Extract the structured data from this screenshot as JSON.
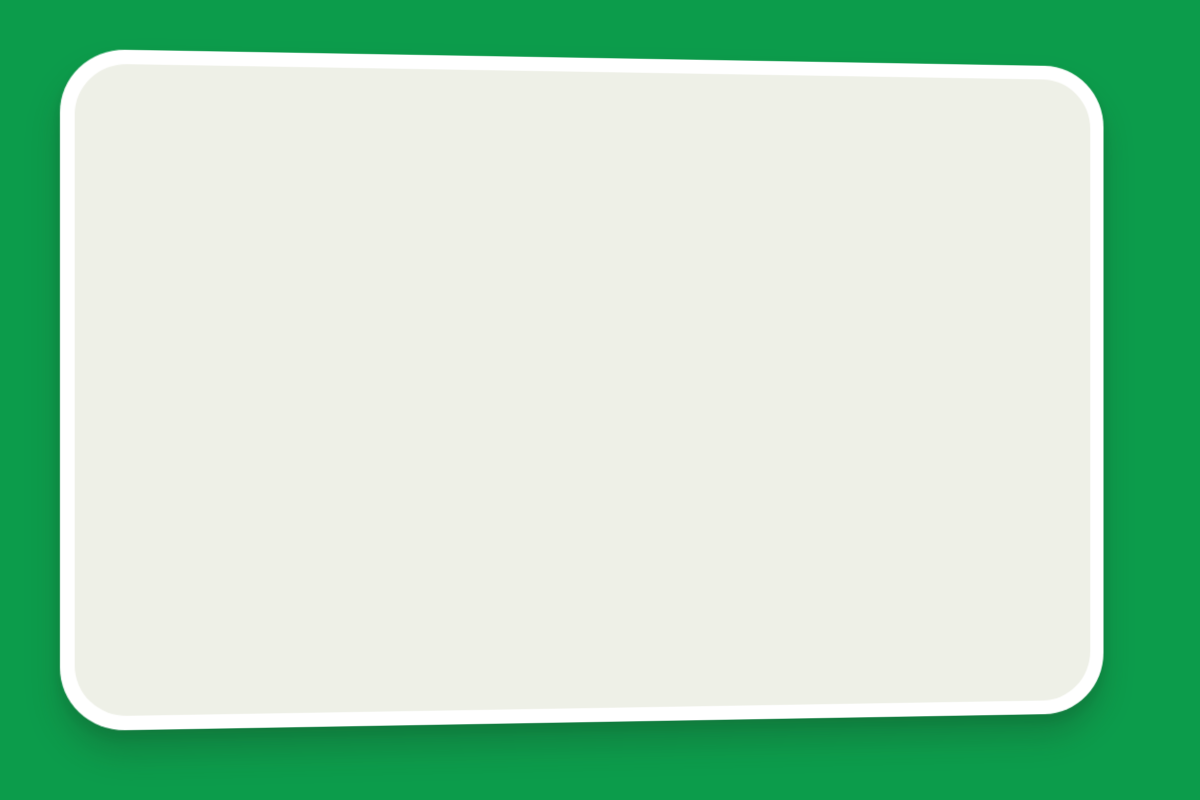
{
  "title": "WOONBLOK H",
  "colors": {
    "green_bg": "#0c9c4b",
    "card": "#ffffff",
    "map_base": "#eef0e7",
    "red_building": "#bf3726",
    "hedge_a": "#61a437",
    "hedge_b": "#417f22",
    "parcel_bg": "#e3eed6",
    "garden": "#d9e9c8",
    "pink_parcel_road": "#f0d8d8",
    "pink_bg_road": "#f5e4e3",
    "salmon": "#dfa89f",
    "road": "#f7f8f4",
    "road_edge": "#dcded4",
    "stall": "#fcfcfa",
    "purple_tree": "#cfc8e0",
    "purple_tree_edge": "#aca2c6",
    "pink_bush": "#e3cfdb",
    "yellow_path": "#efe7ba",
    "yellow_path_dark": "#ded0a0",
    "cars": {
      "gray": "#d6d6d3",
      "orange": "#e39b2d",
      "yellow": "#e6c32f",
      "teal": "#2f93a0",
      "cyan": "#42b6d5",
      "blue": "#4f9bd5",
      "red": "#c23527",
      "green": "#67b63e"
    }
  },
  "scene": {
    "bg_rotation": 42,
    "bands": [
      {
        "v": 1330,
        "h": 115,
        "cls": "yards2"
      },
      {
        "v": 1445,
        "h": 62,
        "cls": "yards"
      },
      {
        "v": 1550,
        "h": 62,
        "cls": "drive",
        "u0": 820,
        "u1": 1460
      },
      {
        "v": 1612,
        "h": 58,
        "cls": "pink",
        "u0": 700,
        "u1": 1420
      },
      {
        "v": 1670,
        "h": 78,
        "cls": "salmon units",
        "u0": 640,
        "u1": 1390
      },
      {
        "v": 1748,
        "h": 55,
        "cls": "yards",
        "u0": 600,
        "u1": 1420
      },
      {
        "v": 1803,
        "h": 46,
        "cls": "road",
        "u0": 500,
        "u1": 1430
      },
      {
        "v": 1849,
        "h": 70,
        "cls": "salmon units",
        "u0": 450,
        "u1": 1360
      },
      {
        "v": 1919,
        "h": 56,
        "cls": "drive",
        "u0": 900,
        "u1": 1950
      },
      {
        "v": 1975,
        "h": 62,
        "cls": "pink",
        "u0": 600,
        "u1": 2100
      },
      {
        "v": 2037,
        "h": 80,
        "cls": "salmon units",
        "u0": 500,
        "u1": 2150
      },
      {
        "v": 2117,
        "h": 60,
        "cls": "yards",
        "u0": 500,
        "u1": 2220
      },
      {
        "v": 2177,
        "h": 48,
        "cls": "road",
        "u0": 500,
        "u1": 2300
      },
      {
        "v": 2225,
        "h": 85,
        "cls": "salmon units",
        "u0": 500,
        "u1": 2300
      }
    ],
    "stall_pairs_world": [
      {
        "u": 870,
        "v": 1562
      },
      {
        "u": 940,
        "v": 1562
      },
      {
        "u": 1010,
        "v": 1562
      },
      {
        "u": 1080,
        "v": 1562
      },
      {
        "u": 1150,
        "v": 1562
      },
      {
        "u": 1290,
        "v": 1562
      },
      {
        "u": 1360,
        "v": 1562
      },
      {
        "u": 1000,
        "v": 1928
      },
      {
        "u": 1070,
        "v": 1928
      },
      {
        "u": 1360,
        "v": 1928
      },
      {
        "u": 1430,
        "v": 1928
      },
      {
        "u": 1680,
        "v": 1928
      },
      {
        "u": 1750,
        "v": 1928
      },
      {
        "u": 1830,
        "v": 1928
      }
    ],
    "world_cars": [
      {
        "u": 1225,
        "v": 1558,
        "c": "red"
      },
      {
        "u": 1500,
        "v": 1930,
        "c": "yellow"
      },
      {
        "u": 1516,
        "v": 1930,
        "c": "yellow"
      },
      {
        "u": 1600,
        "v": 1932,
        "c": "cyan"
      },
      {
        "u": 1616,
        "v": 1932,
        "c": "cyan"
      }
    ],
    "parcel": {
      "x": 366,
      "y": 46,
      "rot": 34,
      "w": 556,
      "h": 348
    },
    "near_parcel": {
      "avenue": {
        "x": -88,
        "y": -60,
        "w": 78,
        "h": 700
      },
      "hedge_lines": [
        -88,
        -16
      ],
      "purple_clusters": [
        {
          "x1": -66,
          "x2": -34,
          "y0": -40,
          "y1": 115
        },
        {
          "x1": -66,
          "x2": -34,
          "y0": 175,
          "y1": 395
        },
        {
          "x1": -66,
          "x2": -34,
          "y0": 430,
          "y1": 625
        },
        {
          "x1": -150,
          "x2": -122,
          "y0": 440,
          "y1": 560
        }
      ],
      "tree_r": 30,
      "tree_step": 30,
      "roads": [
        {
          "x": -170,
          "y": -56,
          "w": 1080,
          "h": 40
        },
        {
          "x": -290,
          "y": 356,
          "w": 1090,
          "h": 42
        }
      ],
      "drive_strip": {
        "x": -290,
        "y": 398,
        "w": 724,
        "h": 56
      },
      "drive_pairs_x": [
        -250,
        -180,
        -110,
        -40,
        30,
        100,
        240,
        310
      ],
      "salmon_bottom": {
        "x": -30,
        "y": 454,
        "w": 780,
        "h": 78
      },
      "pink_bottom": {
        "x": -240,
        "y": 532,
        "w": 1000,
        "h": 56
      }
    },
    "right_zone": {
      "blocks": [
        {
          "x": 796,
          "y": 50,
          "w": 430,
          "h": 32,
          "rot": 38,
          "cls": "road"
        },
        {
          "x": 636,
          "y": 548,
          "w": 430,
          "h": 38,
          "rot": 36,
          "cls": "road"
        },
        {
          "x": 795,
          "y": 12,
          "w": 215,
          "h": 95,
          "rot": 38,
          "cls": "court"
        },
        {
          "x": 843,
          "y": -18,
          "w": 215,
          "h": 82,
          "rot": 38,
          "cls": "salmon units"
        },
        {
          "x": 884,
          "y": 148,
          "w": 210,
          "h": 95,
          "rot": 38,
          "cls": "salmon units"
        },
        {
          "x": 948,
          "y": 540,
          "w": 290,
          "h": 78,
          "rot": 36,
          "cls": "salmon units"
        },
        {
          "x": 1046,
          "y": 672,
          "w": 230,
          "h": 62,
          "rot": 36,
          "cls": "salmon units"
        },
        {
          "x": 893,
          "y": 610,
          "w": 270,
          "h": 58,
          "rot": 36,
          "cls": "drive"
        },
        {
          "x": 180,
          "y": 636,
          "w": 78,
          "h": 60,
          "rot": 40,
          "cls": "salmon"
        },
        {
          "x": 272,
          "y": 684,
          "w": 86,
          "h": 56,
          "rot": 40,
          "cls": "salmon"
        },
        {
          "x": 408,
          "y": 700,
          "w": 94,
          "h": 54,
          "rot": 38,
          "cls": "salmon"
        },
        {
          "x": 538,
          "y": 742,
          "w": 96,
          "h": 46,
          "rot": 38,
          "cls": "salmon"
        }
      ],
      "green_trees": [
        {
          "x": 718,
          "y": 52,
          "r": 40
        },
        {
          "x": 793,
          "y": 110,
          "r": 34
        },
        {
          "x": 862,
          "y": 190,
          "r": 40
        },
        {
          "x": 948,
          "y": 252,
          "r": 46
        },
        {
          "x": 1012,
          "y": 310,
          "r": 46
        },
        {
          "x": 1105,
          "y": 255,
          "r": 30
        },
        {
          "x": 935,
          "y": 418,
          "r": 38
        },
        {
          "x": 993,
          "y": 478,
          "r": 38
        },
        {
          "x": 1046,
          "y": 532,
          "r": 34
        },
        {
          "x": 640,
          "y": 588,
          "r": 30
        },
        {
          "x": 722,
          "y": 662,
          "r": 28
        }
      ],
      "gray_trees": [
        {
          "x": 157,
          "y": 437,
          "r": 28
        },
        {
          "x": 318,
          "y": 628,
          "r": 22
        },
        {
          "x": 395,
          "y": 545,
          "r": 20
        },
        {
          "x": 555,
          "y": 118,
          "r": 26
        },
        {
          "x": 470,
          "y": 60,
          "r": 24
        }
      ],
      "pink_bushes": [
        {
          "x": 808,
          "y": 122,
          "r": 12
        },
        {
          "x": 827,
          "y": 140,
          "r": 11
        },
        {
          "x": 846,
          "y": 158,
          "r": 11
        },
        {
          "x": 865,
          "y": 176,
          "r": 11
        }
      ],
      "tiny_cars": [
        {
          "x": 612,
          "y": 150,
          "c": "red",
          "rot": 38
        },
        {
          "x": 652,
          "y": 206,
          "c": "cyan",
          "rot": 38
        },
        {
          "x": 804,
          "y": 310,
          "c": "yellow",
          "rot": 38
        },
        {
          "x": 817,
          "y": 322,
          "c": "yellow",
          "rot": 38
        },
        {
          "x": 846,
          "y": 590,
          "c": "yellow",
          "rot": 36
        },
        {
          "x": 859,
          "y": 606,
          "c": "yellow",
          "rot": 36
        },
        {
          "x": 898,
          "y": 628,
          "c": "cyan",
          "rot": 36
        },
        {
          "x": 911,
          "y": 645,
          "c": "cyan",
          "rot": 36
        },
        {
          "x": 1056,
          "y": 652,
          "c": "red",
          "rot": 36
        },
        {
          "x": 668,
          "y": 645,
          "c": "red",
          "rot": 120
        },
        {
          "x": 692,
          "y": 658,
          "c": "blue",
          "rot": 120
        },
        {
          "x": 97,
          "y": 570,
          "c": "cyan",
          "rot": 40
        }
      ],
      "yellow_paths": [
        {
          "d": "M 995,50 C 930,80 880,120 846,168 C 812,216 806,256 846,292 C 886,328 900,360 897,420",
          "w": 26,
          "key": "yellow_path"
        },
        {
          "d": "M 846,292 C 880,322 893,350 891,400",
          "w": 26,
          "key": "yellow_path_dark"
        }
      ]
    },
    "parcel_interior": {
      "row_drift_deg": 3,
      "cell": {
        "w": 32,
        "h": 38,
        "gap": 2
      },
      "park_row1": {
        "x": 14,
        "y": 112,
        "cells": [
          "g",
          "gray",
          "gray",
          "g",
          "g",
          "orange",
          "g",
          "gray",
          "gray",
          "g",
          "gray",
          "g",
          "gray",
          "g",
          "orange",
          "cyan"
        ]
      },
      "park_row2": {
        "x": 14,
        "y": 192,
        "cells": [
          "gray",
          "g",
          "teal",
          "g",
          "gray",
          "gray",
          "g",
          "yellow",
          "g",
          "gray",
          "gray",
          "g",
          "cyan",
          "g",
          "gray",
          "red"
        ]
      },
      "road": {
        "x": -10,
        "y": 148,
        "w": 640,
        "h": 40
      },
      "road_cars": [
        {
          "x": 318,
          "c": "cyan"
        },
        {
          "x": 356,
          "c": "red"
        },
        {
          "x": 416,
          "c": "green"
        },
        {
          "x": 452,
          "c": "red"
        }
      ],
      "planter": {
        "x": 322,
        "y": -6,
        "w": 26,
        "h": 26
      },
      "vivid_tree": {
        "x": 334,
        "y": 2,
        "r": 34
      },
      "buildings": [
        {
          "x": 12,
          "y": 12,
          "units": 5,
          "unit_w": 38,
          "h": 52,
          "notch": "top"
        },
        {
          "x": 200,
          "y": 26,
          "units": 5,
          "unit_w": 38,
          "h": 52,
          "notch": "top"
        },
        {
          "x": 420,
          "y": 64,
          "units": 4,
          "unit_w": 34,
          "h": 52,
          "notch": "top"
        },
        {
          "x": 8,
          "y": 222,
          "units": 10,
          "unit_w": 38,
          "h": 52,
          "notch": "bottom"
        },
        {
          "x": 288,
          "y": 286,
          "units": 7,
          "unit_w": 38,
          "h": 52,
          "notch": "bottom"
        }
      ]
    }
  }
}
